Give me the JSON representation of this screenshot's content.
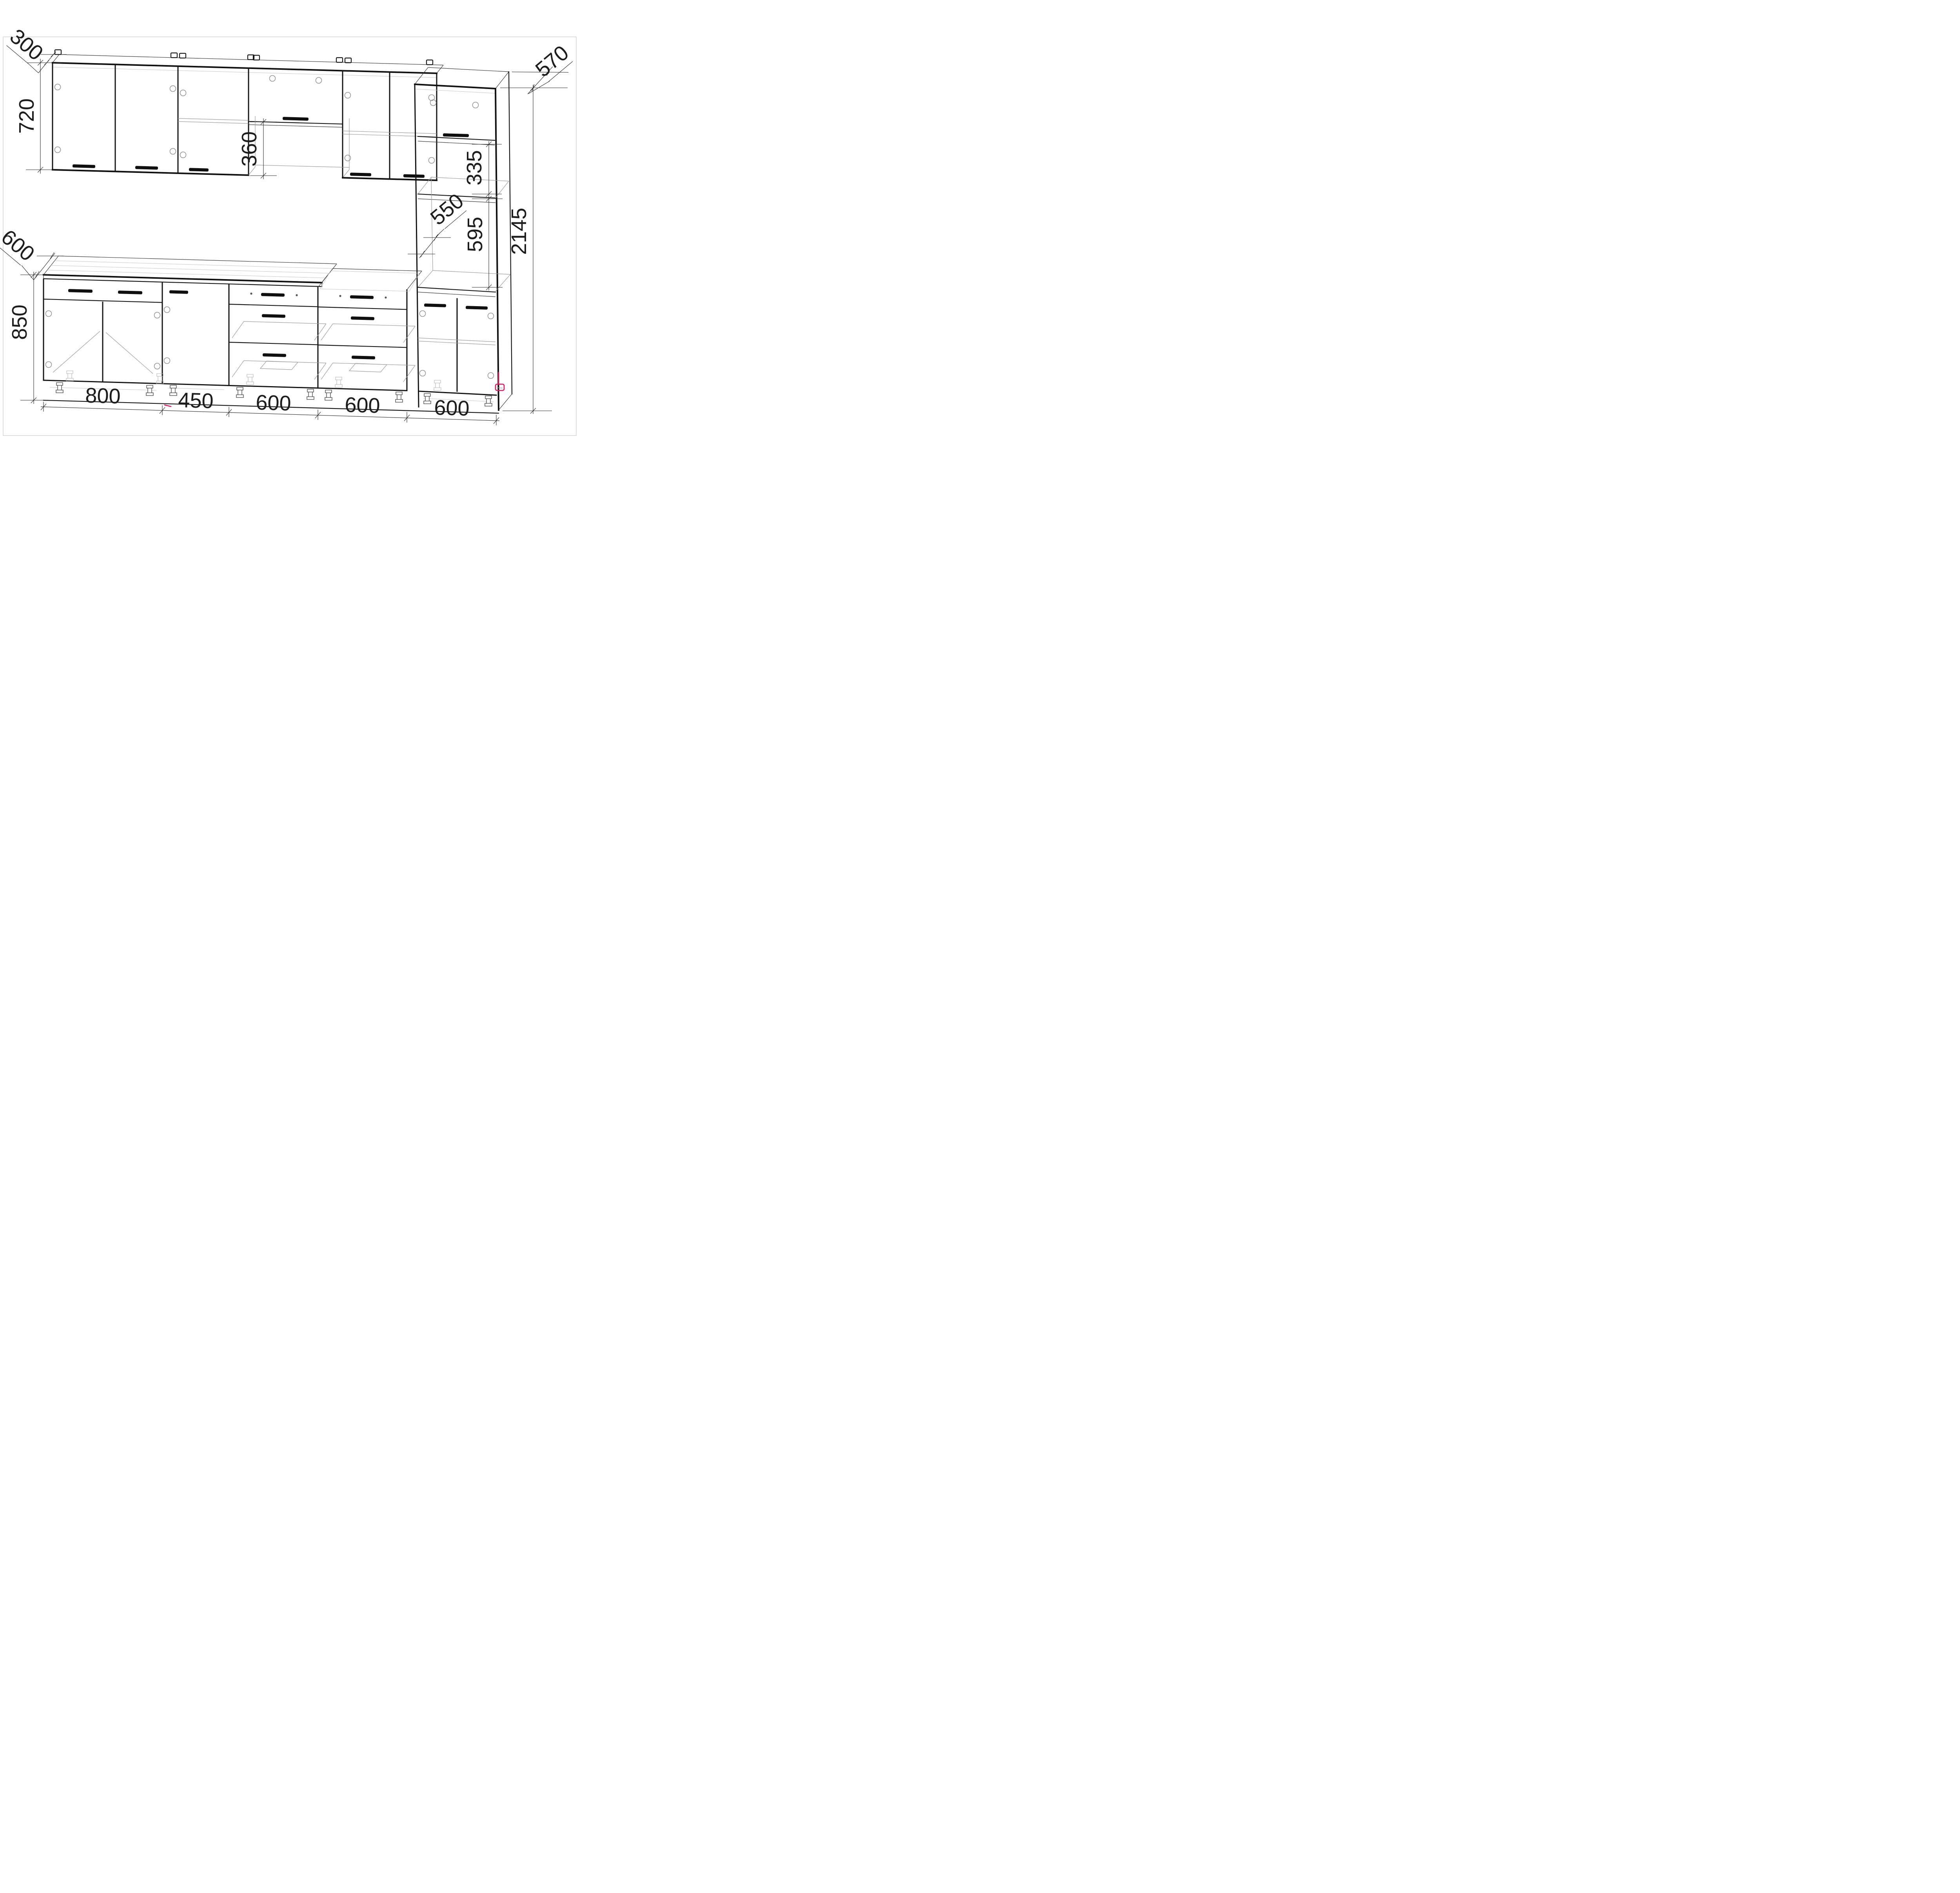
{
  "meta": {
    "type": "kitchen-cabinet-technical-drawing",
    "units": "mm",
    "paper_color": "#ffffff",
    "line_color": "#141414",
    "accent_color": "#e8155d"
  },
  "dims": {
    "wall_depth": "300",
    "wall_height": "720",
    "niche_height": "360",
    "tall_depth": "570",
    "shelf_zone_height": "335",
    "inner_depth": "550",
    "oven_niche_height": "595",
    "total_height": "2145",
    "counter_depth": "600",
    "base_height": "850",
    "width_1": "800",
    "width_2": "450",
    "width_3": "600",
    "width_4": "600",
    "width_5": "600"
  }
}
